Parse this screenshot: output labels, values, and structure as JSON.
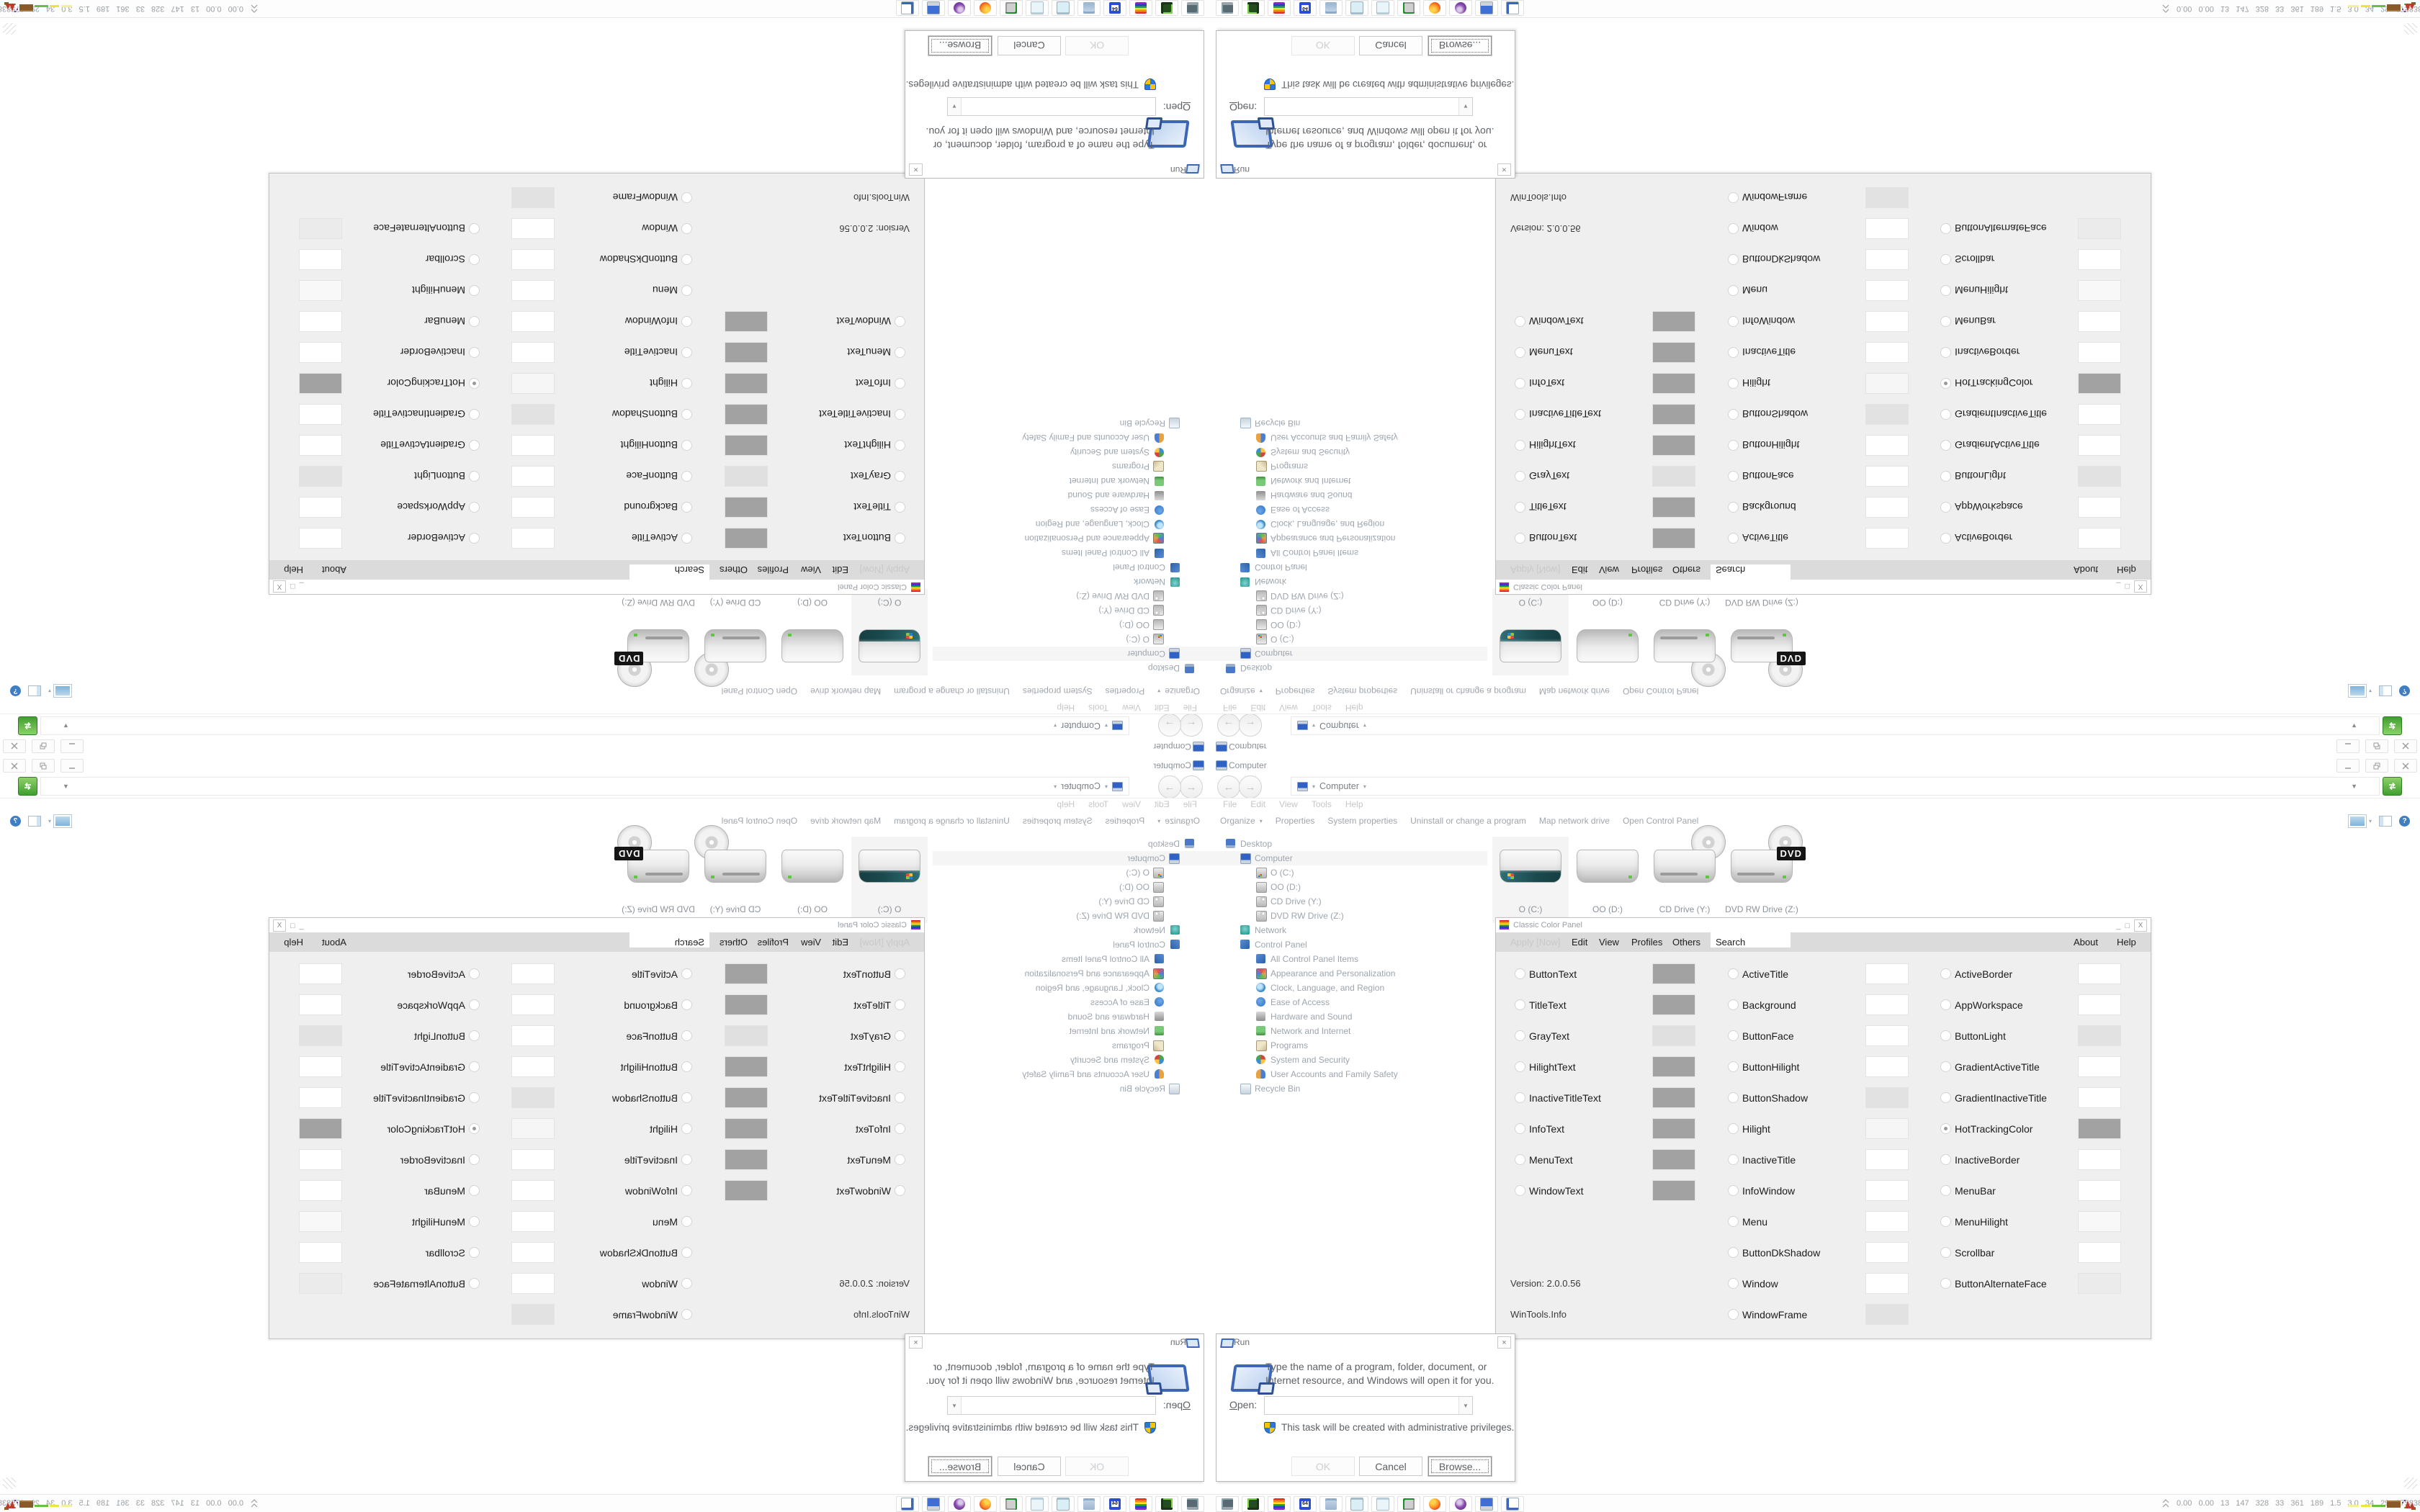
{
  "explorer": {
    "title": "Computer",
    "address_location": "Computer",
    "menu_items": [
      "File",
      "Edit",
      "View",
      "Tools",
      "Help"
    ],
    "toolbar_items": [
      "Organize",
      "Properties",
      "System properties",
      "Uninstall or change a program",
      "Map network drive",
      "Open Control Panel"
    ],
    "tree": [
      {
        "label": "Desktop",
        "icon": "desktop-icon",
        "level": 0
      },
      {
        "label": "Computer",
        "icon": "computer-icon",
        "level": 1,
        "selected": true
      },
      {
        "label": "O (C:)",
        "icon": "os-drive-icon",
        "level": 2
      },
      {
        "label": "OO (D:)",
        "icon": "drive-icon",
        "level": 2
      },
      {
        "label": "CD Drive (Y:)",
        "icon": "cd-drive-icon",
        "level": 2
      },
      {
        "label": "DVD RW Drive (Z:)",
        "icon": "dvd-drive-icon",
        "level": 2
      },
      {
        "label": "Network",
        "icon": "network-icon",
        "level": 1
      },
      {
        "label": "Control Panel",
        "icon": "control-panel-icon",
        "level": 1
      },
      {
        "label": "All Control Panel Items",
        "icon": "control-panel-icon",
        "level": 2
      },
      {
        "label": "Appearance and Personalization",
        "icon": "appearance-icon",
        "level": 2
      },
      {
        "label": "Clock, Language, and Region",
        "icon": "clock-region-icon",
        "level": 2
      },
      {
        "label": "Ease of Access",
        "icon": "ease-of-access-icon",
        "level": 2
      },
      {
        "label": "Hardware and Sound",
        "icon": "hardware-sound-icon",
        "level": 2
      },
      {
        "label": "Network and Internet",
        "icon": "network-internet-icon",
        "level": 2
      },
      {
        "label": "Programs",
        "icon": "programs-icon",
        "level": 2
      },
      {
        "label": "System and Security",
        "icon": "system-security-icon",
        "level": 2
      },
      {
        "label": "User Accounts and Family Safety",
        "icon": "user-accounts-icon",
        "level": 2
      },
      {
        "label": "Recycle Bin",
        "icon": "recycle-bin-icon",
        "level": 1
      }
    ],
    "drives": [
      {
        "name": "O (C:)",
        "type": "os",
        "selected": true
      },
      {
        "name": "OO (D:)",
        "type": "hdd"
      },
      {
        "name": "CD Drive (Y:)",
        "type": "cd"
      },
      {
        "name": "DVD RW Drive (Z:)",
        "type": "dvd",
        "badge": "DVD"
      }
    ]
  },
  "color_panel": {
    "title": "Classic Color Panel",
    "menu": {
      "apply": "Apply [Now]",
      "edit": "Edit",
      "view": "View",
      "profiles": "Profiles",
      "others": "Others",
      "search_value": "Search",
      "about": "About",
      "help": "Help"
    },
    "caption": {
      "min": "_",
      "restore": "□",
      "close": "X"
    },
    "version": "Version: 2.0.0.56",
    "credit": "WinTools.Info",
    "selected_option": "HotTrackingColor",
    "columns": {
      "col1": [
        {
          "label": "ButtonText",
          "swatch": "#a2a2a2"
        },
        {
          "label": "TitleText",
          "swatch": "#a2a2a2"
        },
        {
          "label": "GrayText",
          "swatch": "#e0e0e0"
        },
        {
          "label": "HilightText",
          "swatch": "#a2a2a2"
        },
        {
          "label": "InactiveTitleText",
          "swatch": "#a2a2a2"
        },
        {
          "label": "InfoText",
          "swatch": "#a2a2a2"
        },
        {
          "label": "MenuText",
          "swatch": "#a2a2a2"
        },
        {
          "label": "WindowText",
          "swatch": "#a2a2a2"
        }
      ],
      "col2": [
        {
          "label": "ActiveTitle",
          "swatch": "#ffffff"
        },
        {
          "label": "Background",
          "swatch": "#ffffff"
        },
        {
          "label": "ButtonFace",
          "swatch": "#ffffff"
        },
        {
          "label": "ButtonHilight",
          "swatch": "#ffffff"
        },
        {
          "label": "ButtonShadow",
          "swatch": "#e2e2e2"
        },
        {
          "label": "Hilight",
          "swatch": "#f6f6f6"
        },
        {
          "label": "InactiveTitle",
          "swatch": "#ffffff"
        },
        {
          "label": "InfoWindow",
          "swatch": "#ffffff"
        },
        {
          "label": "Menu",
          "swatch": "#ffffff"
        },
        {
          "label": "ButtonDkShadow",
          "swatch": "#ffffff"
        },
        {
          "label": "Window",
          "swatch": "#ffffff"
        },
        {
          "label": "WindowFrame",
          "swatch": "#e2e2e2"
        }
      ],
      "col3": [
        {
          "label": "ActiveBorder",
          "swatch": "#ffffff"
        },
        {
          "label": "AppWorkspace",
          "swatch": "#ffffff"
        },
        {
          "label": "ButtonLight",
          "swatch": "#e2e2e2"
        },
        {
          "label": "GradientActiveTitle",
          "swatch": "#ffffff"
        },
        {
          "label": "GradientInactiveTitle",
          "swatch": "#ffffff"
        },
        {
          "label": "HotTrackingColor",
          "swatch": "#a2a2a2",
          "selected": true
        },
        {
          "label": "InactiveBorder",
          "swatch": "#ffffff"
        },
        {
          "label": "MenuBar",
          "swatch": "#ffffff"
        },
        {
          "label": "MenuHilight",
          "swatch": "#f8f8f8"
        },
        {
          "label": "Scrollbar",
          "swatch": "#ffffff"
        },
        {
          "label": "ButtonAlternateFace",
          "swatch": "#ebebeb"
        }
      ]
    }
  },
  "run_dialog": {
    "title": "Run",
    "message": "Type the name of a program, folder, document, or Internet resource, and Windows will open it for you.",
    "open_label_initial": "O",
    "open_label_rest": "pen:",
    "open_value": "",
    "admin_note": "This task will be created with administrative privileges.",
    "ok": "OK",
    "cancel": "Cancel",
    "browse": "Browse..."
  },
  "taskbar": {
    "quick_launch": [
      "system-monitor",
      "disk-manager",
      "classic-color-panel",
      "floppy-64",
      "script-editor",
      "notepad",
      "notepad-alt",
      "terminal",
      "firefox",
      "assistant",
      "my-computer",
      "run-window"
    ],
    "floppy_label": "64",
    "tray_stats": "0.00 0.00 13 147 328 33 361 189 1.5 3.0 34 29 27583839"
  },
  "glyphs": {
    "back": "←",
    "forward": "→",
    "caret": "▾",
    "caret_solid": "▼",
    "help": "?",
    "close": "×"
  },
  "theme": {
    "taskbar_bg": "#fdfdfd",
    "selection_bg": "#f4f4f4",
    "menu_bg": "#dbdbdb",
    "window_bg": "#efefef",
    "accent_green": "#3f9f2f"
  }
}
